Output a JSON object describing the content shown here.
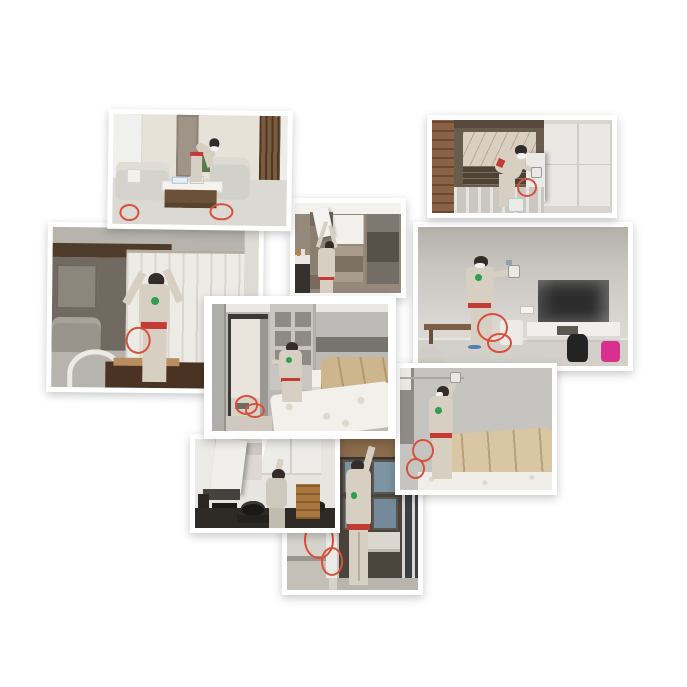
{
  "page": {
    "kind": "photo-collage",
    "background": "#ffffff",
    "description": "Collage of nine photos of technicians in beige uniforms with masks performing indoor spray treatment (air purification / formaldehyde removal service) in a furnished apartment"
  },
  "theme": {
    "uniform": "#d7d0c2",
    "uniform_dark": "#c3bcae",
    "cap": "#322d29",
    "mask": "#f2f1ee",
    "belt": "#c23b35",
    "logo": "#2f9e4e",
    "hose": "#d8503c"
  },
  "collage": {
    "photos": [
      {
        "id": "living-room",
        "label": "Technician leaning over a light grey leather sofa set spraying near a white coffee table; wooden lattice screen and plant in the living room"
      },
      {
        "id": "entry-cabinet",
        "label": "Technician bent over spraying inside an opened white entry cabinet with marble splashback and wooden door frame"
      },
      {
        "id": "curtain",
        "label": "Technician seen from behind lifting a white sheer curtain under a dark wood beam, dining table and white chair in front"
      },
      {
        "id": "display-shelf",
        "label": "Technician reaching up to treat a wall unit with white doors, open cubbies and smoked-glass display cabinets"
      },
      {
        "id": "tv-wall",
        "label": "Technician spraying a grey wall beside a plastic-wrapped TV on a white media stand, wooden bench, white appliance, backpack and pink bag on the floor"
      },
      {
        "id": "bedroom",
        "label": "Bright-bordered photo of a bedroom: technician crouching at an open grey shelf unit, open door to hallway, bare mattress on a bed with beige headboard"
      },
      {
        "id": "bed-headboard",
        "label": "Technician with arm raised spraying the wall above a beige channel-stitched headboard and bare mattress"
      },
      {
        "id": "kitchen",
        "label": "Technician reaching into an opened white kitchen wall cabinet above a dark counter with a wok on the stove"
      },
      {
        "id": "wardrobe",
        "label": "Technician seen from behind reaching up into an open wardrobe with blue-grey interior panels, red hose coiled on the floor"
      }
    ]
  }
}
